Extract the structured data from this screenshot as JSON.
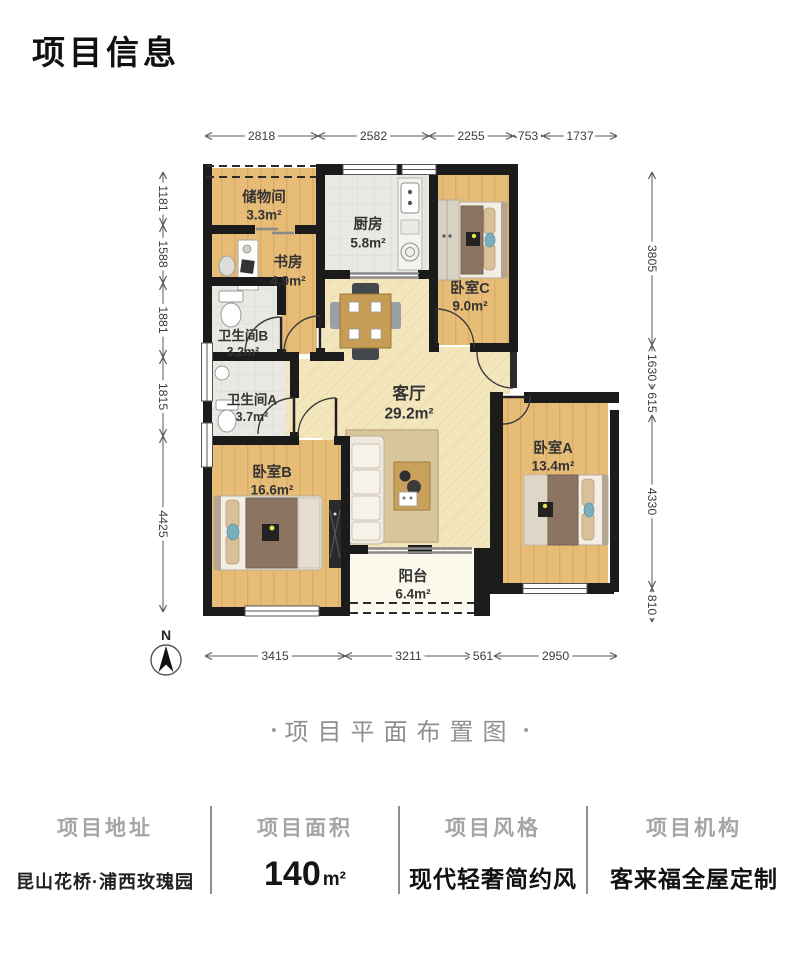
{
  "header": {
    "title": "项目信息"
  },
  "caption": {
    "left_dot": "•",
    "text": "项目平面布置图",
    "right_dot": "•"
  },
  "floor_plan": {
    "north_label": "N",
    "rooms": [
      {
        "id": "storage",
        "name": "储物间",
        "area": "3.3m²",
        "cx": 264,
        "cy": 198,
        "acy": 215,
        "fs": 14.5
      },
      {
        "id": "kitchen",
        "name": "厨房",
        "area": "5.8m²",
        "cx": 368,
        "cy": 225,
        "acy": 243,
        "fs": 14.5
      },
      {
        "id": "study",
        "name": "书房",
        "area": "4.9m²",
        "cx": 288,
        "cy": 263,
        "acy": 281,
        "fs": 14.5
      },
      {
        "id": "bathroom-b",
        "name": "卫生间B",
        "area": "3.2m²",
        "cx": 243,
        "cy": 336,
        "acy": 352,
        "fs": 13.5
      },
      {
        "id": "bathroom-a",
        "name": "卫生间A",
        "area": "3.7m²",
        "cx": 252,
        "cy": 400,
        "acy": 417,
        "fs": 13.5
      },
      {
        "id": "living-room",
        "name": "客厅",
        "area": "29.2m²",
        "cx": 409,
        "cy": 394,
        "acy": 414,
        "fs": 16.5
      },
      {
        "id": "bedroom-c",
        "name": "卧室C",
        "area": "9.0m²",
        "cx": 470,
        "cy": 289,
        "acy": 306,
        "fs": 14.5
      },
      {
        "id": "bedroom-a",
        "name": "卧室A",
        "area": "13.4m²",
        "cx": 553,
        "cy": 449,
        "acy": 466,
        "fs": 14.5
      },
      {
        "id": "bedroom-b",
        "name": "卧室B",
        "area": "16.6m²",
        "cx": 272,
        "cy": 473,
        "acy": 490,
        "fs": 14.5
      },
      {
        "id": "balcony",
        "name": "阳台",
        "area": "6.4m²",
        "cx": 413,
        "cy": 577,
        "acy": 594,
        "fs": 14.5
      }
    ],
    "dimensions": {
      "top": {
        "line_pos": 136,
        "ticks": [
          205,
          318,
          429,
          513,
          543,
          617
        ],
        "labels": [
          "2818",
          "2582",
          "2255",
          "753",
          "1737"
        ]
      },
      "left": {
        "line_pos": 163,
        "ticks": [
          172,
          225,
          283,
          357,
          436,
          612
        ],
        "labels": [
          "1181",
          "1588",
          "1881",
          "1815",
          "4425"
        ]
      },
      "right": {
        "line_pos": 652,
        "ticks": [
          172,
          345,
          390,
          415,
          588,
          622
        ],
        "labels": [
          "3805",
          "1630",
          "615",
          "4330",
          "810"
        ]
      },
      "bottom": {
        "line_pos": 656,
        "ticks": [
          205,
          345,
          472,
          494,
          617
        ],
        "labels": [
          "3415",
          "3211",
          "561",
          "2950"
        ]
      }
    }
  },
  "footer": {
    "columns": [
      {
        "label": "项目地址",
        "value": "昆山花桥·浦西玫瑰园"
      },
      {
        "label": "项目面积",
        "value": "140",
        "unit": "m²"
      },
      {
        "label": "项目风格",
        "value": "现代轻奢简约风"
      },
      {
        "label": "项目机构",
        "value": "客来福全屋定制"
      }
    ]
  },
  "colors": {
    "wall": "#1b1b1b",
    "wood_floor": "#e6bc77",
    "tile_floor": "#e9e8e3",
    "living_floor": "#f3e5bc",
    "balcony_floor": "#fbf8ec",
    "rug": "#d8c59c",
    "blanket": "#8b7562",
    "pillow": "#d9c098",
    "accent_teal": "#79aebc",
    "label_text": "#3a3a3a",
    "dim_text": "#3d3d3d",
    "caption_text": "#8f8f8f"
  }
}
